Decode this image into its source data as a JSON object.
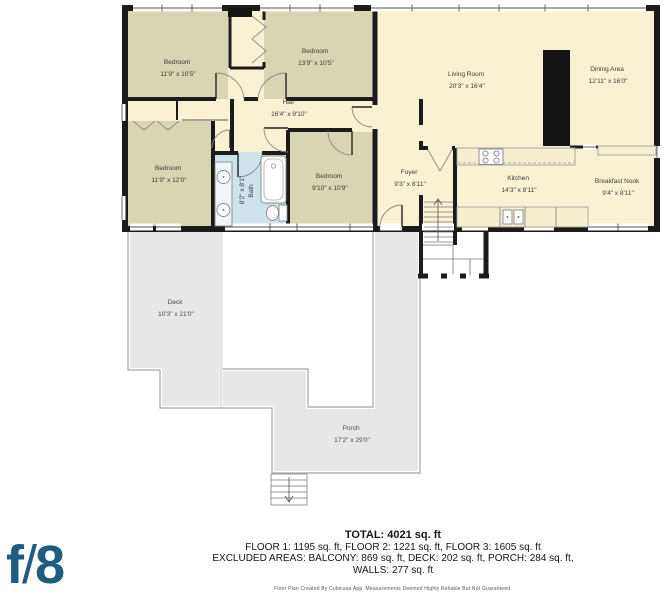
{
  "document": {
    "type": "floor-plan",
    "floor_shown": "FLOOR 2"
  },
  "rooms": {
    "bedroom1": {
      "name": "Bedroom",
      "dims": "11'9\" x 10'5\""
    },
    "bedroom2": {
      "name": "Bedroom",
      "dims": "13'9\" x 10'5\""
    },
    "hall": {
      "name": "Hall",
      "dims": "16'4\" x 9'10\""
    },
    "bedroom3": {
      "name": "Bedroom",
      "dims": "11'9\" x 12'0\""
    },
    "bath": {
      "name": "Bath",
      "dims": "8'2\" x 8'1\""
    },
    "bedroom4": {
      "name": "Bedroom",
      "dims": "9'10\" x 10'9\""
    },
    "living_room": {
      "name": "Living Room",
      "dims": "20'3\" x 16'4\""
    },
    "dining_area": {
      "name": "Dining Area",
      "dims": "12'11\" x 16'0\""
    },
    "foyer": {
      "name": "Foyer",
      "dims": "9'3\" x 8'11\""
    },
    "kitchen": {
      "name": "Kitchen",
      "dims": "14'3\" x 8'11\""
    },
    "breakfast_nook": {
      "name": "Breakfast Nook",
      "dims": "9'4\" x 8'11\""
    },
    "deck": {
      "name": "Deck",
      "dims": "10'3\" x 21'0\""
    },
    "porch": {
      "name": "Porch",
      "dims": "17'2\" x 29'0\""
    }
  },
  "summary": {
    "total": "TOTAL: 4021 sq. ft",
    "floors": "FLOOR 1: 1195 sq. ft, FLOOR 2: 1221 sq. ft, FLOOR 3: 1605 sq. ft",
    "excluded": "EXCLUDED AREAS: BALCONY: 869 sq. ft, DECK: 202 sq. ft, PORCH: 284 sq. ft,",
    "walls": "WALLS: 277 sq. ft",
    "disclaimer": "Floor Plan Created By Cubicasa App. Measurements Deemed Highly Reliable But Not Guaranteed."
  },
  "logo": {
    "text_f": "f",
    "text_slash": "/",
    "text_8": "8"
  },
  "colors": {
    "wall": "#1b1b1b",
    "room_cream": "#f9f2d2",
    "bedroom_olive": "#d8d5b2",
    "bath_blue": "#cfe3ed",
    "outdoor_gray": "#e7e7e7",
    "logo_blue": "#1e5c80"
  }
}
